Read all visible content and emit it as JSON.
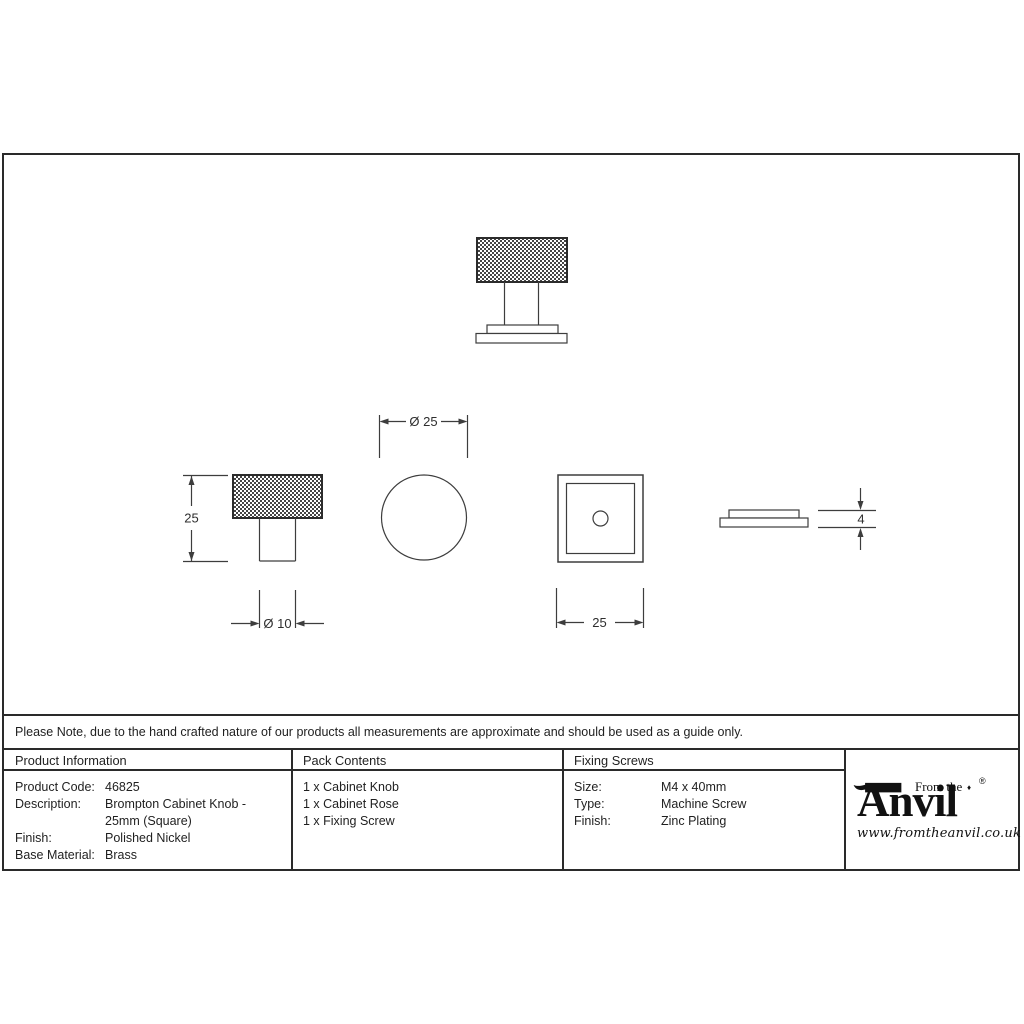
{
  "note": {
    "text": "Please Note, due to the hand crafted nature of our products all measurements are approximate and should be used as a guide only."
  },
  "drawing": {
    "dimensions": {
      "overall_height": "25",
      "stem_diameter": "Ø 10",
      "knob_diameter": "Ø 25",
      "rose_width": "25",
      "rose_thickness": "4"
    }
  },
  "table": {
    "product_information": {
      "header": "Product Information",
      "rows": [
        {
          "label": "Product Code:",
          "value": "46825"
        },
        {
          "label": "Description:",
          "value": "Brompton Cabinet Knob - 25mm (Square)"
        },
        {
          "label": "Finish:",
          "value": "Polished Nickel"
        },
        {
          "label": "Base Material:",
          "value": "Brass"
        }
      ]
    },
    "pack_contents": {
      "header": "Pack Contents",
      "items": [
        "1 x Cabinet Knob",
        "1 x Cabinet Rose",
        "1 x Fixing Screw"
      ]
    },
    "fixing_screws": {
      "header": "Fixing Screws",
      "rows": [
        {
          "label": "Size:",
          "value": "M4 x 40mm"
        },
        {
          "label": "Type:",
          "value": "Machine Screw"
        },
        {
          "label": "Finish:",
          "value": "Zinc Plating"
        }
      ]
    }
  },
  "brand": {
    "from_the": "From the",
    "name": "Anvil",
    "registered": "®",
    "diamond": "♦",
    "website": "www.fromtheanvil.co.uk"
  },
  "colors": {
    "line": "#3d3d3d",
    "border": "#2a2a2a",
    "text": "#1f1f1f"
  }
}
